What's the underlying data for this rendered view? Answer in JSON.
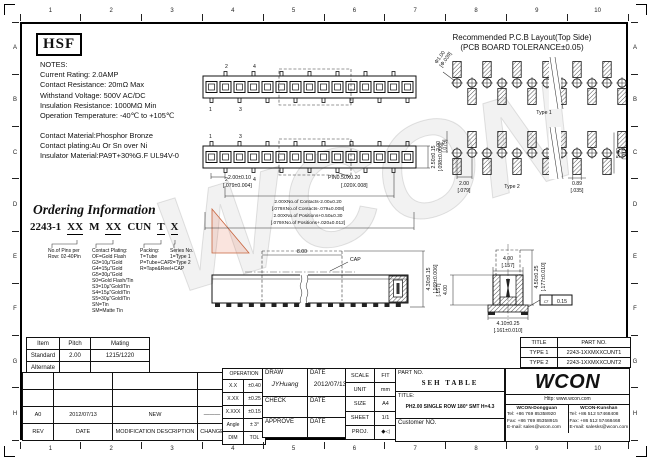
{
  "sheet": {
    "watermark": "WCON",
    "cols": [
      "1",
      "2",
      "3",
      "4",
      "5",
      "6",
      "7",
      "8",
      "9",
      "10"
    ],
    "rows": [
      "A",
      "B",
      "C",
      "D",
      "E",
      "F",
      "G",
      "H"
    ]
  },
  "logo": {
    "text": "HSF"
  },
  "notes": {
    "heading": "NOTES:",
    "lines": [
      "Current Rating: 2.0AMP",
      "Contact Resistance: 20mΩ Max",
      "Withstand Voltage: 500V AC/DC",
      "Insulation Resistance: 1000MΩ Min",
      "Operation Temperature: -40℃ to +105℃"
    ],
    "materials": [
      "Contact Material:Phosphor Bronze",
      "Contact plating:Au Or Sn over Ni",
      "Insulator Material:PA9T+30%G.F UL94V-0"
    ]
  },
  "ordering": {
    "title": "Ordering Information",
    "code": [
      "2243-1",
      "XX",
      "M",
      "XX",
      "CUN",
      "T",
      "X"
    ],
    "pins": [
      "No.of Pins per",
      "Row: 02-40Pin"
    ],
    "plating": [
      "Contact Plating:",
      "OF=Gold Flash",
      "G3=10µ\"Gold",
      "G4=15µ\"Gold",
      "G5=30µ\"Gold",
      "S0=Gold Flash/Tin",
      "S3=10µ\"Gold/Tin",
      "S4=15µ\"Gold/Tin",
      "S5=30µ\"Gold/Tin",
      "SN=Tin",
      "SM=Matte Tin"
    ],
    "packing": [
      "Packing:",
      "T=Tube",
      "P=Tube+CAP",
      "R=Tape&Reel+CAP"
    ],
    "series": [
      "Series No.",
      "1=Type 1",
      "2=Type 2"
    ]
  },
  "mating_table": {
    "headers": [
      "Item",
      "Pitch",
      "Mating"
    ],
    "rows": [
      [
        "Standard",
        "2.00",
        "1215/1220"
      ],
      [
        "Alternate",
        "",
        ""
      ]
    ]
  },
  "pcb": {
    "title": "Recommended P.C.B Layout(Top Side)",
    "subtitle": "(PCB BOARD TOLERANCE±0.05)",
    "hole": "Φ1.00",
    "hole_in": "[Φ.039]",
    "type1": "Type 1",
    "type2": "Type 2",
    "v_pitch": "2.00",
    "v_pitch_in": "[.079]",
    "h_pitch": "2.00",
    "h_pitch_in": "[.079]",
    "pad_w": "0.89",
    "pad_w_in": "[.035]",
    "span": "5.40",
    "span_in": "[.212]"
  },
  "views": {
    "pin_labels": [
      "1",
      "2",
      "3",
      "4"
    ],
    "top": {
      "pitch": "2.00±0.10",
      "pitch_in": "[.079±0.004]",
      "pin": "PIN0.50X0.20",
      "pin_in": "[.020X.008]",
      "contacts": "2.00XNo.of Contacts-2.00±0.20",
      "contacts_in": "[.079XNo.of Contacts-.079±0.008]",
      "positions": "2.00XNo.of Positions+0.50±0.30",
      "positions_in": "[.079XNo.of Positions+.020±0.012]",
      "height": "2.50±0.15",
      "height_in": "[.098±0.006]"
    },
    "side": {
      "cap_len": "8.00",
      "cap": "CAP",
      "height": "4.30±0.15",
      "height_in": "[.169±0.006]"
    },
    "end": {
      "width": "4.00",
      "width_in": "[.157]",
      "height": "4.50±0.25",
      "height_in": "[.177±0.010]",
      "body": "4.00",
      "body_in": "[.157]",
      "base": "4.10±0.25",
      "base_in": "[.161±0.010]",
      "flat_sym": "▱",
      "flat_val": "0.15"
    }
  },
  "type_table": {
    "headers": [
      "TITLE",
      "PART NO."
    ],
    "rows": [
      [
        "TYPE 1",
        "2243-1XXMXXCUNT1"
      ],
      [
        "TYPE 2",
        "2243-1XXMXXCUNT2"
      ]
    ]
  },
  "title_block": {
    "revision": {
      "row": [
        "A0",
        "2012/07/13",
        "NEW",
        "———"
      ],
      "headers": [
        "REV",
        "DATE",
        "MODIFICATION DESCRIPTION",
        "CHANGE"
      ]
    },
    "tolerance": {
      "header": "OPERATION",
      "rows": [
        [
          "X.X",
          "±0.40"
        ],
        [
          "X.XX",
          "±0.25"
        ],
        [
          "X.XXX",
          "±0.15"
        ],
        [
          "Angle",
          "± 3°"
        ],
        [
          "DIM",
          "TOL"
        ]
      ]
    },
    "sign": {
      "draw": "DRAW",
      "draw_name": "JYHuang",
      "date": "DATE",
      "draw_date": "2012/07/13",
      "check": "CHECK",
      "approve": "APPROVE"
    },
    "scale": {
      "rows": [
        [
          "SCALE",
          "FIT"
        ],
        [
          "UNIT",
          "mm"
        ],
        [
          "SIZE",
          "A4"
        ],
        [
          "SHEET",
          "1/1"
        ],
        [
          "PROJ.",
          "◆◁"
        ]
      ]
    },
    "part": {
      "part_label": "PART NO.",
      "part_value": "SEH TABLE",
      "title_label": "TITLE:",
      "title_value": "PH2.00 SINGLE ROW 180° SMT H=4.3",
      "customer": "Customer NO."
    },
    "wcon": {
      "logo": "WCON",
      "url": "Http:  www.wcon.com",
      "offices": [
        {
          "name": "WCON-Dongguan",
          "tel": "Tel: +86 769 85358920",
          "fax": "Fax: +86 769 85358915",
          "email": "E-mail: sales@wcon.com"
        },
        {
          "name": "WCON-Kunshan",
          "tel": "Tel: +86 512 57468408",
          "fax": "Fax: +86 512 57468468",
          "email": "E-mail: salesks@wcon.com"
        }
      ]
    }
  }
}
